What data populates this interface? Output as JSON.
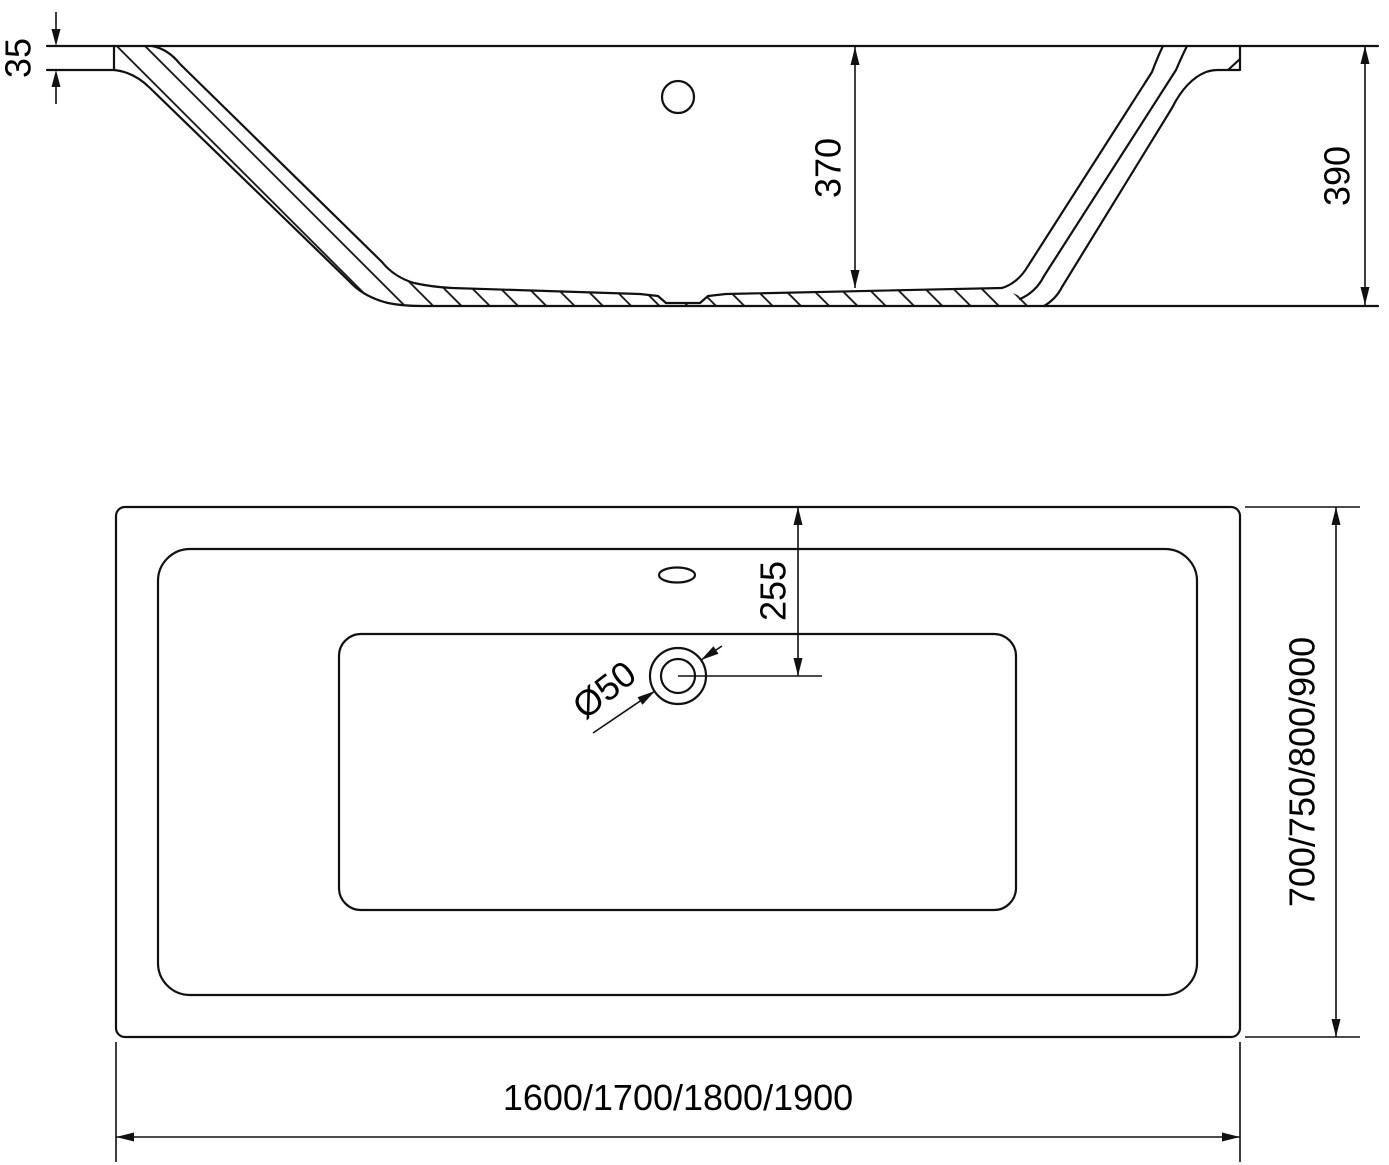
{
  "drawing": {
    "background": "#ffffff",
    "line_color": "#111111",
    "views": {
      "section": {
        "name": "bathtub-side-cross-section",
        "dims": {
          "rim_thickness": "35",
          "inner_depth": "370",
          "overall_height": "390"
        },
        "features": [
          "overflow-hole",
          "hatched-wall-section",
          "drain-recess"
        ]
      },
      "plan": {
        "name": "bathtub-top-plan-view",
        "dims": {
          "drain_center_offset": "255",
          "drain_diameter": "Ø50",
          "width_variants": "700/750/800/900",
          "length_variants": "1600/1700/1800/1900"
        },
        "features": [
          "faucet-hole",
          "drain-hole",
          "rim-edge",
          "basin-floor"
        ]
      }
    }
  }
}
